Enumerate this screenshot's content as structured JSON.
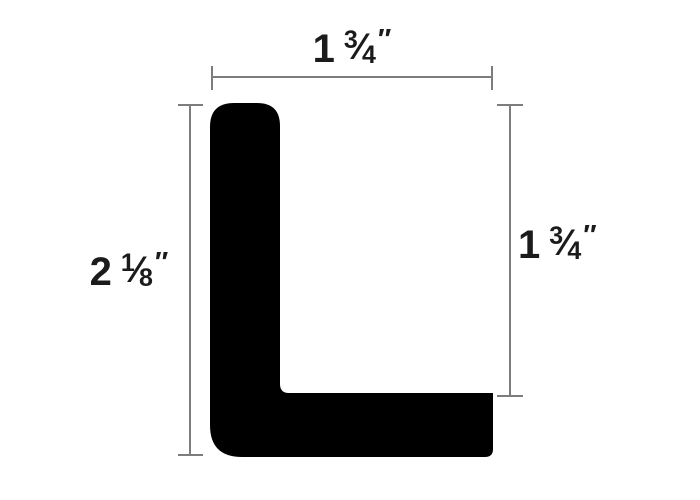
{
  "drawing": {
    "description": "Cross-section dimension drawing of a black L-shaped profile",
    "shape_name": "l-shaped-profile"
  },
  "colors": {
    "shape_fill": "#000000",
    "dimension_line": "#7d7d7d",
    "label_text": "#1b1b1b",
    "background": "#ffffff"
  },
  "glyphs": {
    "fraction_slash": "⁄"
  },
  "dimensions": {
    "top": {
      "full_text": "1 3/4\"",
      "whole": "1",
      "numerator": "3",
      "denominator": "4",
      "unit": "″"
    },
    "left": {
      "full_text": "2 1/8\"",
      "whole": "2",
      "numerator": "1",
      "denominator": "8",
      "unit": "″"
    },
    "right": {
      "full_text": "1 3/4\"",
      "whole": "1",
      "numerator": "3",
      "denominator": "4",
      "unit": "″"
    }
  }
}
